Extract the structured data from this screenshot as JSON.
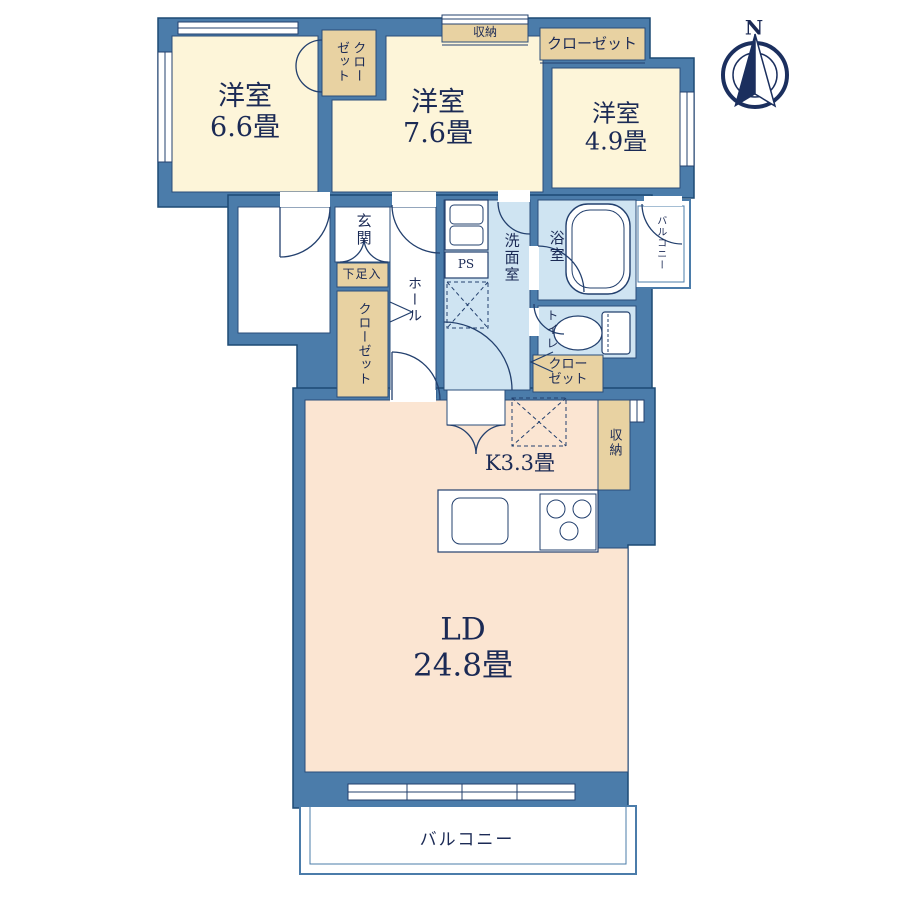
{
  "compass": {
    "north_label": "N"
  },
  "rooms": {
    "bedroom_66": {
      "name": "洋室",
      "size": "6.6畳"
    },
    "bedroom_76": {
      "name": "洋室",
      "size": "7.6畳"
    },
    "bedroom_49": {
      "name": "洋室",
      "size": "4.9畳"
    },
    "living_dining": {
      "name": "LD",
      "size": "24.8畳"
    },
    "kitchen": {
      "label": "K3.3畳"
    },
    "entrance": {
      "label": "玄関"
    },
    "hall": {
      "label": "ホール"
    },
    "washroom": {
      "label": "洗面室"
    },
    "bathroom": {
      "label": "浴室"
    },
    "toilet": {
      "label": "トイレ"
    },
    "pipe_space": {
      "label": "PS"
    },
    "shoe_cabinet": {
      "label": "下足入"
    }
  },
  "storage": {
    "closet_between_bedrooms": "クロー\nゼット",
    "closet_top_right": "クローゼット",
    "storage_top": "収納",
    "closet_hall": "クローゼット",
    "closet_washroom": "クロー\nゼット",
    "storage_kitchen": "収納"
  },
  "balcony": {
    "main": "バルコニー",
    "side": "バルコニー"
  },
  "colors": {
    "wall": "#4b7caa",
    "wall_outline": "#1d4a74",
    "floor_bedroom": "#fdf5d9",
    "floor_wet": "#cfe4f2",
    "floor_ldk": "#fbe5d2",
    "closet_fill": "#e8d2a2",
    "line": "#23406e",
    "text": "#1b2a55"
  }
}
